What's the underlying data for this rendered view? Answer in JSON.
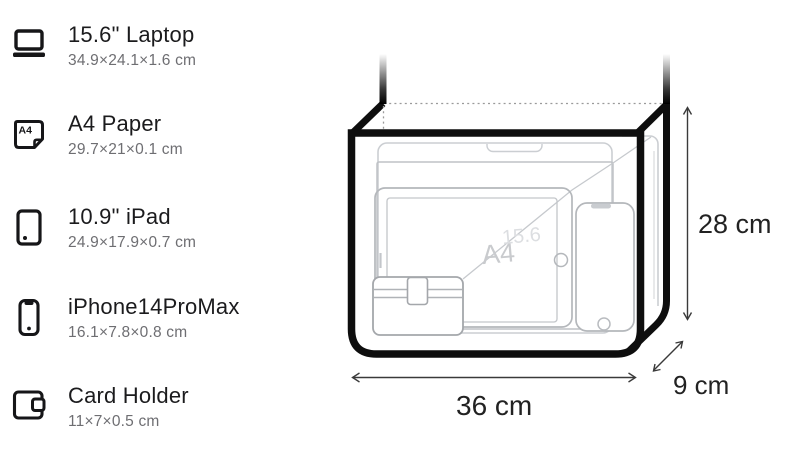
{
  "spec_list": {
    "items": [
      {
        "title": "15.6\" Laptop",
        "dims": "34.9×24.1×1.6 cm"
      },
      {
        "title": "A4 Paper",
        "dims": "29.7×21×0.1 cm"
      },
      {
        "title": "10.9\" iPad",
        "dims": "24.9×17.9×0.7 cm"
      },
      {
        "title": "iPhone14ProMax",
        "dims": "16.1×7.8×0.8 cm"
      },
      {
        "title": "Card Holder",
        "dims": "11×7×0.5 cm"
      }
    ],
    "a4_icon_label": "A4"
  },
  "diagram": {
    "bag": {
      "width_label": "36 cm",
      "height_label": "28 cm",
      "depth_label": "9 cm"
    },
    "watermarks": {
      "a4_paper": "A4",
      "laptop": "15.6"
    },
    "colors": {
      "bag_outline": "#0e0e0e",
      "item_outline": "#b5b8bc",
      "dimension_lines": "#3a3a3a",
      "label_text": "#222222",
      "title_text": "#1b1b1d",
      "dims_text": "#6e6e72"
    }
  }
}
